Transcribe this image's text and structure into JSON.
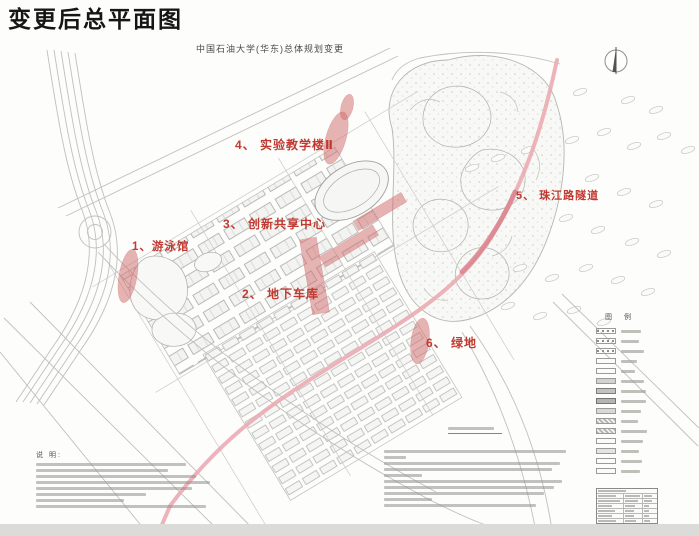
{
  "page": {
    "title": "变更后总平面图",
    "subtitle": "中国石油大学(华东)总体规划变更"
  },
  "annotations": [
    {
      "id": 1,
      "text": "1、游泳馆"
    },
    {
      "id": 2,
      "text": "2、 地下车库"
    },
    {
      "id": 3,
      "text": "3、 创新共享中心"
    },
    {
      "id": 4,
      "text": "4、 实验教学楼Ⅱ"
    },
    {
      "id": 5,
      "text": "5、 珠江路隧道"
    },
    {
      "id": 6,
      "text": "6、 绿地"
    }
  ],
  "legend": {
    "title": "图 例"
  },
  "notes": {
    "title": "说 明:"
  },
  "colors": {
    "annotation_red": "#c13a32",
    "highlight_fill": "#d06a6a",
    "road_pink": "#eaacb2",
    "tunnel_pink": "#d9848e",
    "drawing_gray": "#bfc1bd"
  }
}
